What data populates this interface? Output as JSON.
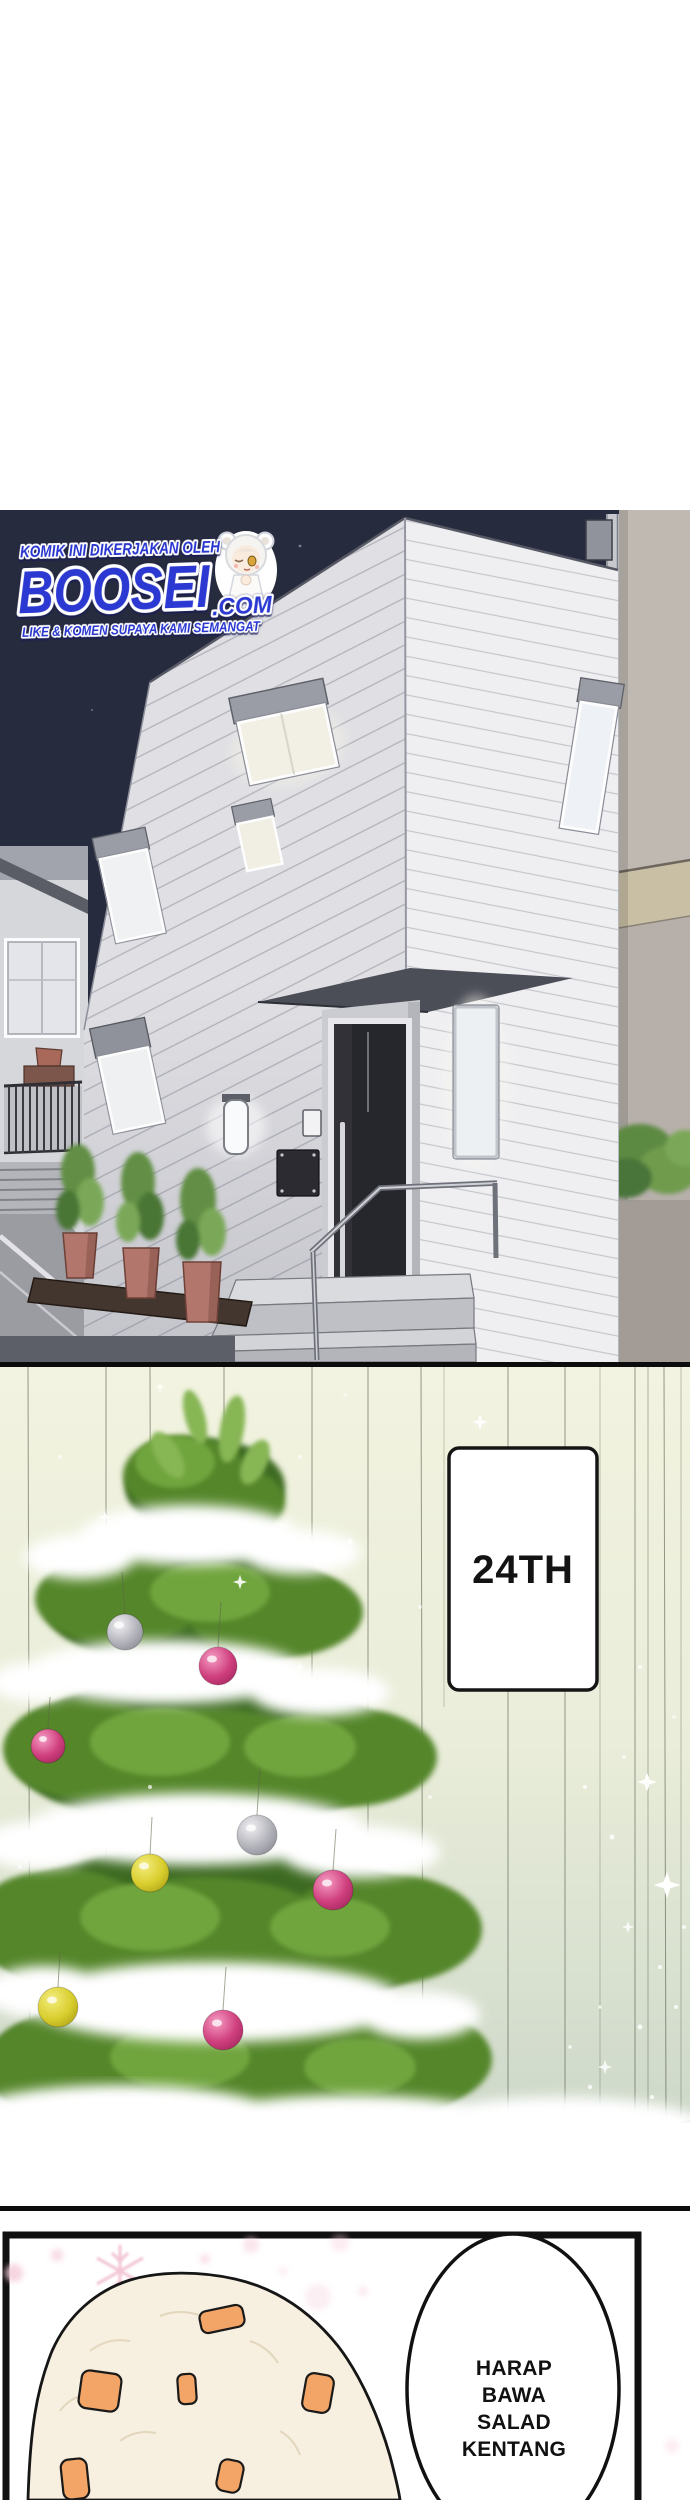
{
  "watermark": {
    "credit_line": "KOMIK INI DIKERJAKAN OLEH",
    "brand": "BOOSEI",
    "brand_suffix": ".COM",
    "tagline": "LIKE & KOMEN SUPAYA KAMI SEMANGAT",
    "brand_color": "#2b38d2",
    "mascot_icon": "chibi-girl-bear-hood"
  },
  "panels": {
    "house_night": {
      "sky_color": "#272b3e",
      "house_wall_color": "#ededf0"
    },
    "christmas_tree": {
      "date_sign_label": "24TH",
      "curtain_top_color": "#f2f3e0",
      "curtain_bottom_color": "#c8d4c6",
      "bauble_pink": "#cf3f7e",
      "bauble_yellow": "#d9ce2e",
      "bauble_silver": "#b3b3bb"
    },
    "potato_salad": {
      "speech_lines": [
        "HARAP",
        "BAWA",
        "SALAD",
        "KENTANG"
      ],
      "salad_color": "#f7efdf",
      "carrot_color": "#f2a566"
    }
  }
}
